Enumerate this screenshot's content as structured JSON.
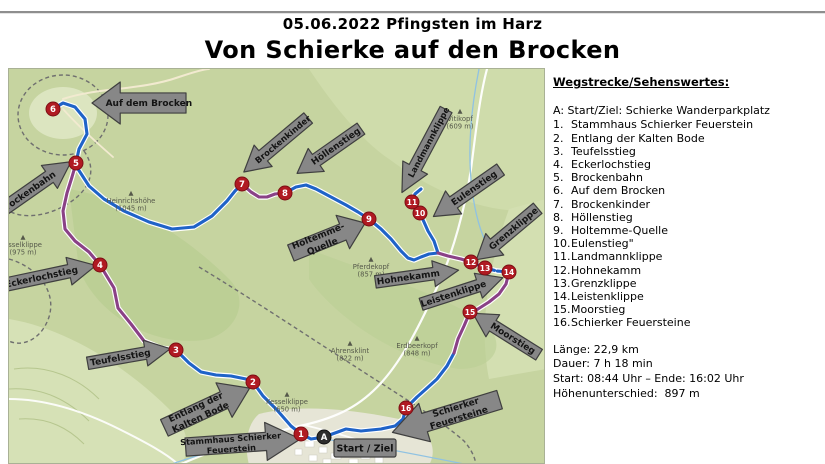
{
  "header": {
    "date_line": "05.06.2022 Pfingsten im Harz",
    "main_title": "Von Schierke auf den Brocken"
  },
  "sidebar": {
    "heading": "Wegstrecke/Sehenswertes:",
    "start_item": "A: Start/Ziel: Schierke Wanderparkplatz",
    "items": [
      "Stammhaus Schierker Feuerstein",
      "Entlang der Kalten Bode",
      "Teufelsstieg",
      "Eckerlochstieg",
      "Brockenbahn",
      "Auf dem Brocken",
      "Brockenkinder",
      "Höllenstieg",
      "Holtemme-Quelle",
      "Eulenstieg\"",
      "Landmannklippe",
      "Hohnekamm",
      "Grenzklippe",
      "Leistenklippe",
      "Moorstieg",
      "Schierker Feuersteine"
    ],
    "stats": [
      "Länge: 22,9 km",
      "Dauer: 7 h 18 min",
      "Start: 08:44 Uhr – Ende: 16:02 Uhr",
      "Höhenunterschied:  897 m"
    ]
  },
  "map": {
    "colors": {
      "route_blue": "#1f63c8",
      "route_purple": "#8a4186",
      "arrow_fill": "#878787",
      "arrow_stroke": "#3f3f3f",
      "marker_fill": "#b01a22",
      "marker_stroke": "#7c0e14",
      "marker_start": "#2d2d2d"
    },
    "start_label": {
      "text": "Start / Ziel",
      "x": 325,
      "y": 370,
      "w": 62,
      "h": 18
    },
    "arrows": [
      {
        "label": [
          "Auf dem Brocken"
        ],
        "cx": 130,
        "cy": 34,
        "w": 94,
        "h": 42,
        "rot": 0,
        "dir": "left"
      },
      {
        "label": [
          "Brockenbahn"
        ],
        "cx": 26,
        "cy": 118,
        "w": 88,
        "h": 28,
        "rot": -35,
        "dir": "right"
      },
      {
        "label": [
          "Eckerlochstieg"
        ],
        "cx": 42,
        "cy": 206,
        "w": 92,
        "h": 28,
        "rot": -12,
        "dir": "right"
      },
      {
        "label": [
          "Teufelsstieg"
        ],
        "cx": 120,
        "cy": 287,
        "w": 84,
        "h": 26,
        "rot": -10,
        "dir": "right"
      },
      {
        "label": [
          "Entlang der",
          "Kalten Bode"
        ],
        "cx": 198,
        "cy": 339,
        "w": 94,
        "h": 38,
        "rot": -25,
        "dir": "right"
      },
      {
        "label": [
          "Stammhaus Schierker",
          "Feuerstein"
        ],
        "cx": 234,
        "cy": 374,
        "w": 115,
        "h": 38,
        "rot": -4,
        "dir": "right",
        "fs": 8.2
      },
      {
        "label": [
          "Schierker",
          "Feuersteine"
        ],
        "cx": 437,
        "cy": 347,
        "w": 112,
        "h": 40,
        "rot": -17,
        "dir": "left"
      },
      {
        "label": [
          "Moorstieg"
        ],
        "cx": 497,
        "cy": 265,
        "w": 78,
        "h": 26,
        "rot": 32,
        "dir": "left"
      },
      {
        "label": [
          "Leistenklippe"
        ],
        "cx": 453,
        "cy": 222,
        "w": 86,
        "h": 26,
        "rot": -18,
        "dir": "right"
      },
      {
        "label": [
          "Hohnekamm"
        ],
        "cx": 408,
        "cy": 207,
        "w": 84,
        "h": 26,
        "rot": -8,
        "dir": "right"
      },
      {
        "label": [
          "Holtemme-",
          "Quelle"
        ],
        "cx": 319,
        "cy": 169,
        "w": 80,
        "h": 36,
        "rot": -22,
        "dir": "right"
      },
      {
        "label": [
          "Höllenstieg"
        ],
        "cx": 320,
        "cy": 82,
        "w": 78,
        "h": 28,
        "rot": -35,
        "dir": "left"
      },
      {
        "label": [
          "Brockenkinder"
        ],
        "cx": 267,
        "cy": 76,
        "w": 84,
        "h": 28,
        "rot": -40,
        "dir": "left",
        "fs": 8.5
      },
      {
        "label": [
          "Landmannklippe"
        ],
        "cx": 415,
        "cy": 82,
        "w": 94,
        "h": 28,
        "rot": -62,
        "dir": "left",
        "fs": 8.4
      },
      {
        "label": [
          "Eulenstieg"
        ],
        "cx": 458,
        "cy": 124,
        "w": 82,
        "h": 28,
        "rot": -35,
        "dir": "left"
      },
      {
        "label": [
          "Grenzklippe"
        ],
        "cx": 498,
        "cy": 165,
        "w": 80,
        "h": 28,
        "rot": -40,
        "dir": "left"
      }
    ],
    "markers": [
      {
        "label": "1",
        "x": 292,
        "y": 365
      },
      {
        "label": "2",
        "x": 244,
        "y": 313
      },
      {
        "label": "3",
        "x": 167,
        "y": 281
      },
      {
        "label": "4",
        "x": 91,
        "y": 196
      },
      {
        "label": "5",
        "x": 67,
        "y": 94
      },
      {
        "label": "6",
        "x": 44,
        "y": 40
      },
      {
        "label": "7",
        "x": 233,
        "y": 115
      },
      {
        "label": "8",
        "x": 276,
        "y": 124
      },
      {
        "label": "9",
        "x": 360,
        "y": 150
      },
      {
        "label": "10",
        "x": 411,
        "y": 144
      },
      {
        "label": "11",
        "x": 403,
        "y": 133
      },
      {
        "label": "12",
        "x": 462,
        "y": 193
      },
      {
        "label": "13",
        "x": 476,
        "y": 199
      },
      {
        "label": "14",
        "x": 500,
        "y": 203
      },
      {
        "label": "15",
        "x": 461,
        "y": 243
      },
      {
        "label": "16",
        "x": 397,
        "y": 339
      },
      {
        "label": "A",
        "x": 315,
        "y": 368,
        "type": "start"
      }
    ],
    "peaks": [
      {
        "name": "Heinrichshöhe",
        "elev": "(1045 m)",
        "x": 122,
        "y": 126
      },
      {
        "name": "Pferdekopf",
        "elev": "(857 m)",
        "x": 362,
        "y": 192
      },
      {
        "name": "Vitikopf",
        "elev": "(609 m)",
        "x": 451,
        "y": 44
      },
      {
        "name": "Ahrensklint",
        "elev": "(822 m)",
        "x": 341,
        "y": 276
      },
      {
        "name": "Erdbeerkopf",
        "elev": "(848 m)",
        "x": 408,
        "y": 271
      },
      {
        "name": "Kesselklippe",
        "elev": "(650 m)",
        "x": 278,
        "y": 327
      },
      {
        "name": "esselklippe",
        "elev": "(975 m)",
        "x": 14,
        "y": 170
      }
    ]
  }
}
